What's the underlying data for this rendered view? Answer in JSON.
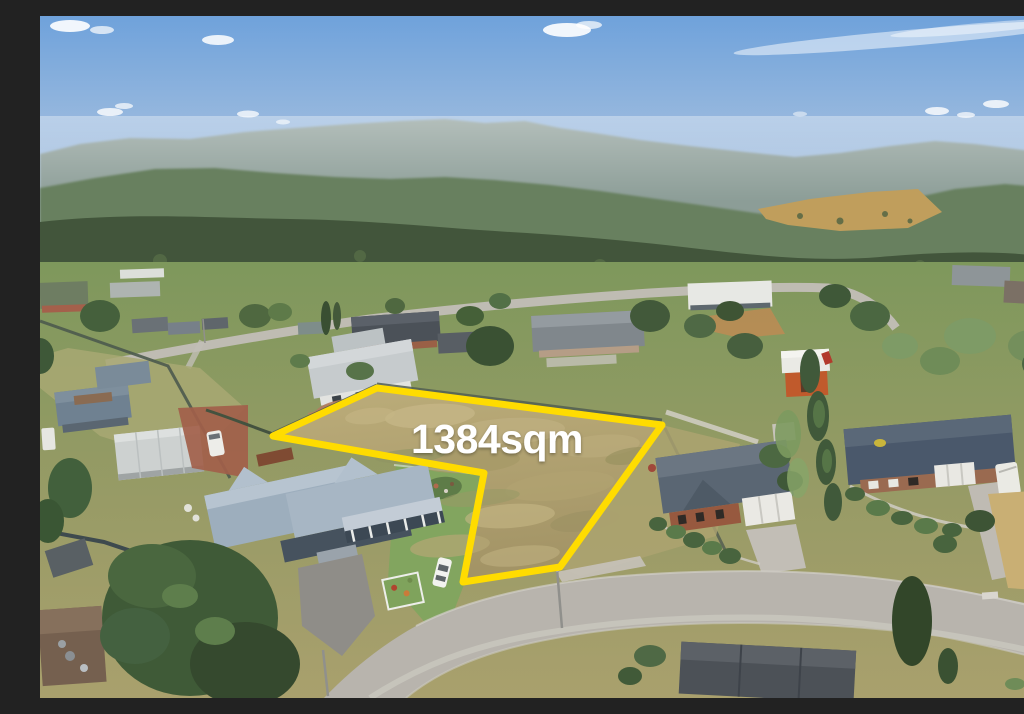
{
  "scene": {
    "type": "aerial-real-estate-photo",
    "description": "Aerial drone photograph of a vacant residential block outlined in yellow, surrounded by suburban houses and gardens, a curving street in the foreground, dense forested hills and a blue sky with scattered clouds"
  },
  "overlay": {
    "area_label": "1384sqm",
    "boundary_color": "#FFDC00",
    "label_color": "#FFFFFF"
  },
  "palette": {
    "sky_top": "#6FA2DB",
    "sky_horizon": "#D8E2EB",
    "mountain_far": "#8C9D97",
    "mountain_mid": "#68805F",
    "forest_dark": "#42553B",
    "valley_clearing": "#C09E5C",
    "suburb_grass": "#7E985C",
    "dry_grass": "#A9A06D",
    "lot_grass_light": "#BCAD7A",
    "lot_grass_dark": "#A39466",
    "road": "#B8B4AD"
  }
}
